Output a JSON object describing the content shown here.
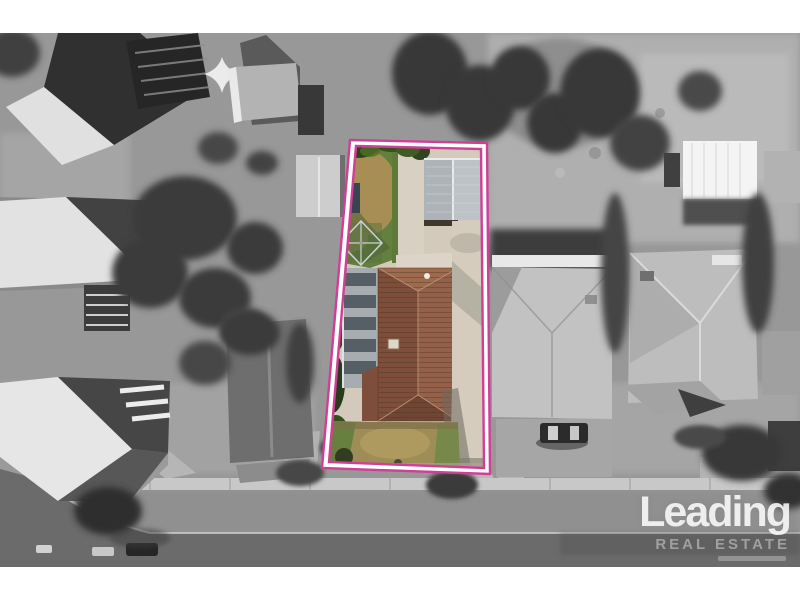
{
  "watermark": {
    "brand": "Leading",
    "tagline": "REAL ESTATE"
  },
  "colors": {
    "boundary_pink": "#d03f95",
    "boundary_white": "#ffffff",
    "roof_terracotta": "#936049",
    "lawn_green": "#64803e",
    "lawn_dried": "#9f8d58"
  }
}
